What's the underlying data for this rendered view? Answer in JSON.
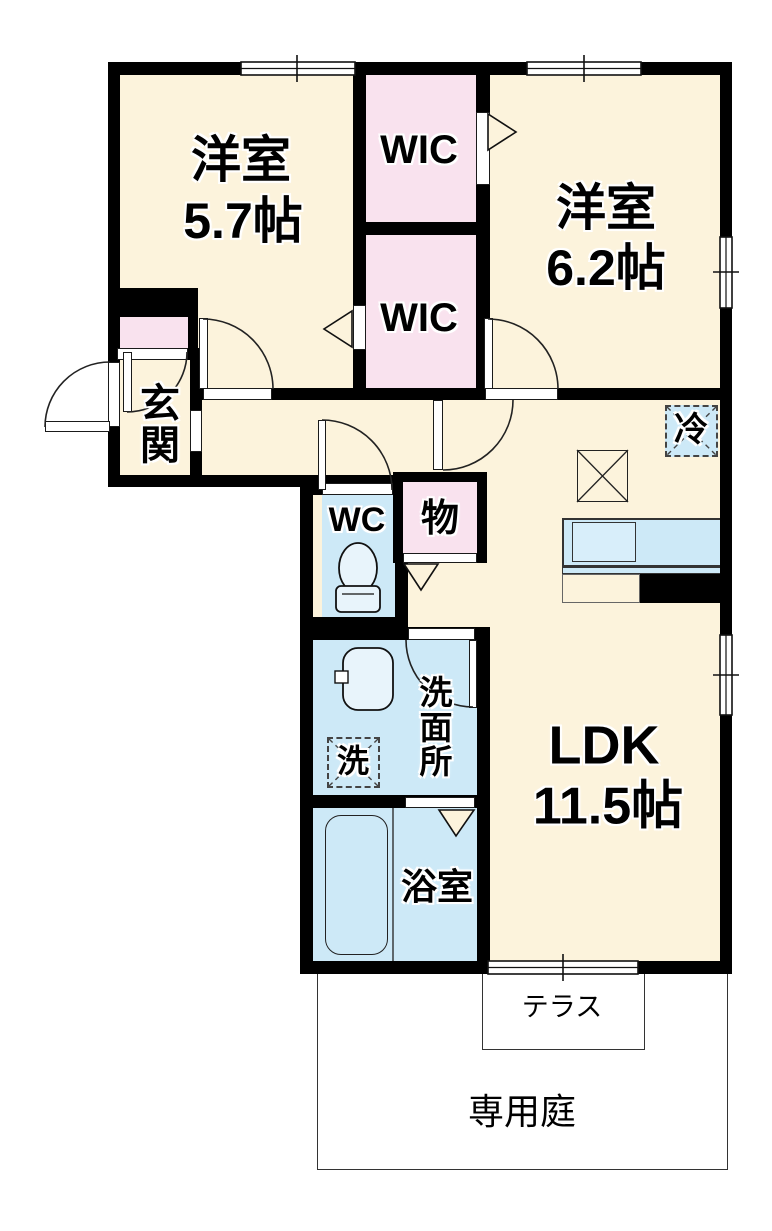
{
  "plan": {
    "bedroom1": {
      "name": "洋室",
      "size": "5.7帖"
    },
    "bedroom2": {
      "name": "洋室",
      "size": "6.2帖"
    },
    "wic_upper": {
      "name": "WIC"
    },
    "wic_lower": {
      "name": "WIC"
    },
    "entrance": {
      "name": "玄関"
    },
    "toilet": {
      "name": "WC"
    },
    "storage": {
      "name": "物"
    },
    "refrigerator": {
      "name": "冷"
    },
    "ldk": {
      "name": "LDK",
      "size": "11.5帖"
    },
    "washroom": {
      "name": "洗面所"
    },
    "washer": {
      "name": "洗"
    },
    "bathroom": {
      "name": "浴室"
    },
    "terrace": {
      "name": "テラス"
    },
    "garden": {
      "name": "専用庭"
    }
  },
  "colors": {
    "room_floor": "#FCF3DC",
    "closet_floor": "#F9E2EE",
    "wet_area": "#CDE9F7",
    "wall": "#000000",
    "background": "#FFFFFF"
  }
}
